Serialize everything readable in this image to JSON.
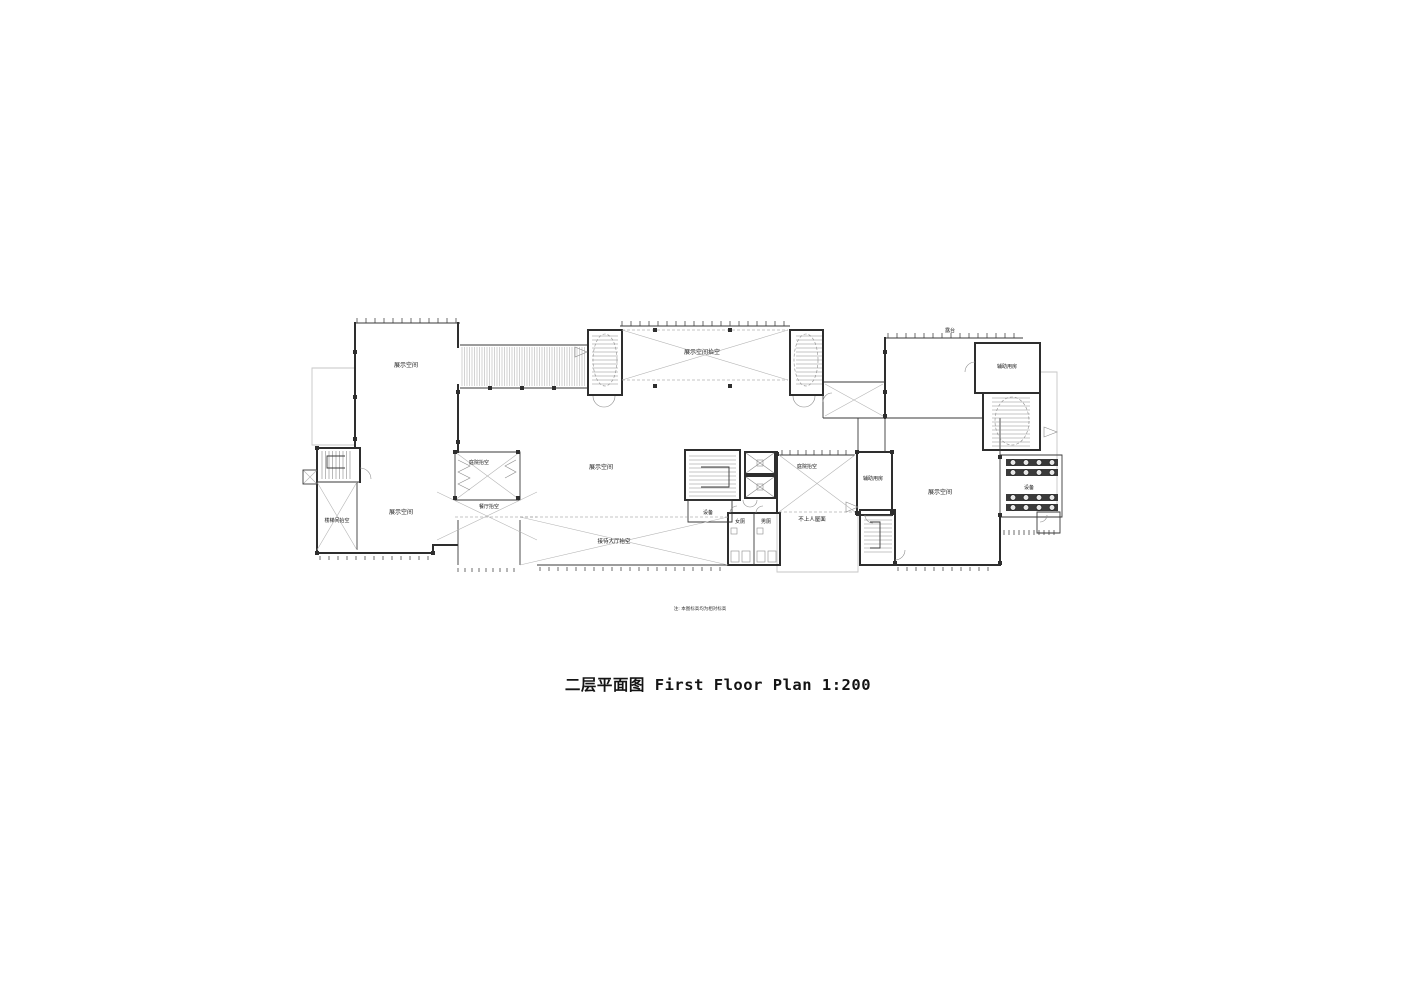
{
  "title": "二层平面图 First Floor Plan 1:200",
  "note": "注: 本图标高均为相对标高",
  "colors": {
    "background": "#ffffff",
    "line_dark": "#2e2e2e",
    "line_light": "#c6c6c6",
    "void_cross": "#b5b5b5",
    "text": "#141414"
  },
  "scale": "1:200",
  "rooms": {
    "exhibition_top_left": "展示空间",
    "exhibition_void_top": "展示空间抬空",
    "terrace": "露台",
    "aux_room_top_right": "辅助用房",
    "courtyard_void_left": "庭院抬空",
    "exhibition_center": "展示空间",
    "courtyard_void_right": "庭院抬空",
    "aux_room_center": "辅助用房",
    "exhibition_right": "展示空间",
    "equipment_right": "设备",
    "dining_void": "餐厅抬空",
    "exhibition_bottom_left": "展示空间",
    "stairwell_void": "楼梯间抬空",
    "equipment_center": "设备",
    "womens_toilet": "女厕",
    "mens_toilet": "男厕",
    "inaccessible_roof": "不上人屋面",
    "reception_hall_void": "接待大厅抬空"
  }
}
